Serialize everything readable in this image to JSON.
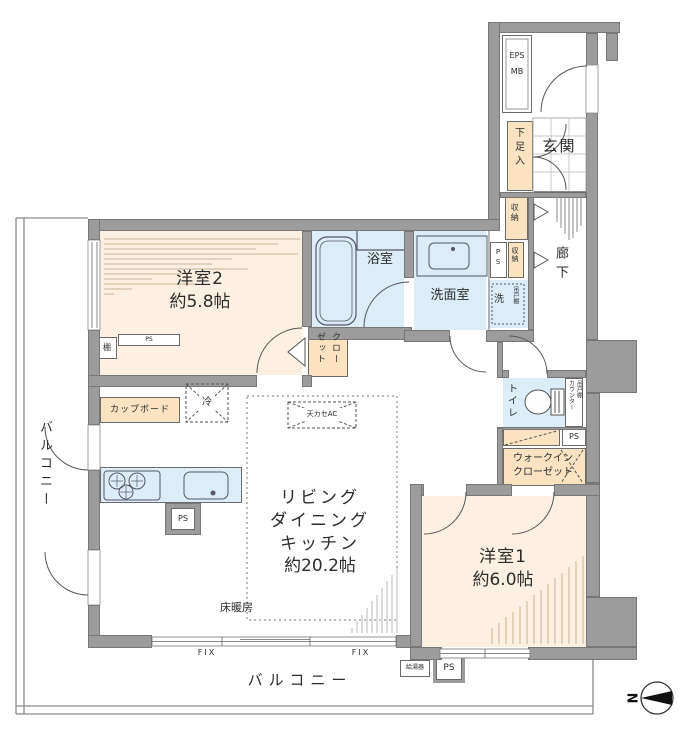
{
  "colors": {
    "wall": "#9c9c9c",
    "room_floor": "#fdf0e2",
    "storage_fill": "#fbe3c1",
    "wet_area_fill": "#dcedf8",
    "shading_line": "#c9b295"
  },
  "rooms": {
    "western2": {
      "name": "洋室2",
      "size": "約5.8帖"
    },
    "western1": {
      "name": "洋室1",
      "size": "約6.0帖"
    },
    "ldk": {
      "name": "リビング\nダイニング\nキッチン",
      "size": "約20.2帖"
    }
  },
  "labels": {
    "eps": "EPS",
    "mb": "MB",
    "entrance": "玄関",
    "shoe_box": "下足入",
    "storage": "収納",
    "corridor": "廊下",
    "ps": "PS",
    "washer": "洗",
    "hanging_cupboard": "吊戸棚",
    "bathroom": "浴室",
    "washroom": "洗面室",
    "toilet": "トイレ",
    "counter": "カウンター",
    "closet": "クローゼット",
    "walkin_line1": "ウォークイン",
    "walkin_line2": "クローゼット",
    "shelf": "棚",
    "cupboard": "カップボード",
    "fridge": "冷",
    "ceiling_ac": "天カセAC",
    "floor_heating": "床暖房",
    "fix": "FIX",
    "balcony": "バルコニー",
    "water_heater": "給湯器",
    "north": "N"
  }
}
